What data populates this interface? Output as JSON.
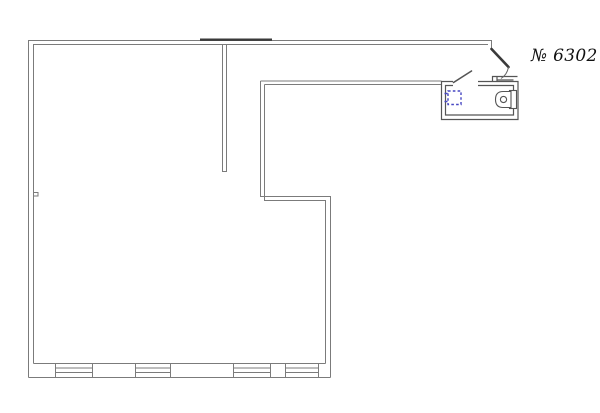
{
  "plan": {
    "unit_number": "№ 6302"
  },
  "colors": {
    "background": "#ffffff",
    "wall": "#7b7b7b",
    "wall_dark": "#3a3a3a",
    "bathroom_wall": "#555555",
    "fixture_blue": "#4747c2",
    "tank_fill": "#c9c9c9",
    "label_text": "#111111"
  },
  "features": {
    "window_count": 4,
    "icons": [
      "toilet-icon",
      "sink-icon",
      "entry-door-icon",
      "bathroom-door-icon",
      "window-icon"
    ]
  }
}
